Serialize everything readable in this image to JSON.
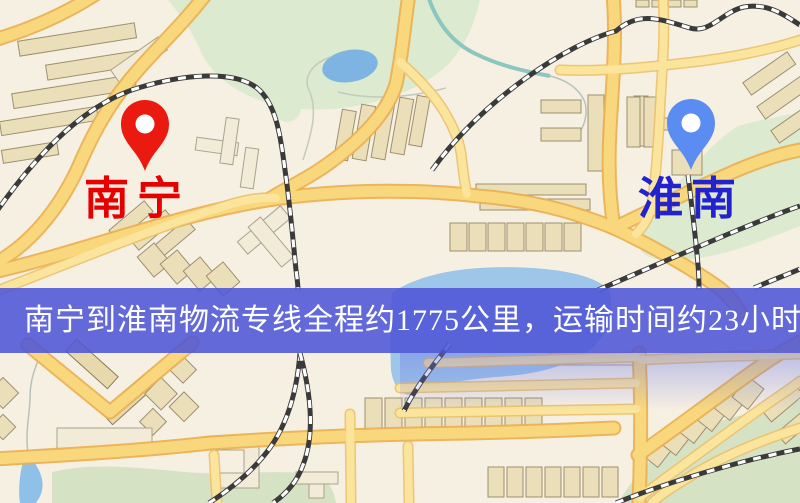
{
  "map": {
    "origin": {
      "name": "南宁",
      "pin_color": "#ea1a10",
      "label_color": "#e60000"
    },
    "destination": {
      "name": "淮南",
      "pin_color": "#5b8cf2",
      "label_color": "#2323cd"
    },
    "banner": {
      "text": "南宁到淮南物流专线全程约1775公里，运输时间约23小时48分钟.",
      "background_color": "#5055d6",
      "text_color": "#ffffff",
      "distance": "约1775公里",
      "duration": "约23小时48分钟"
    }
  }
}
